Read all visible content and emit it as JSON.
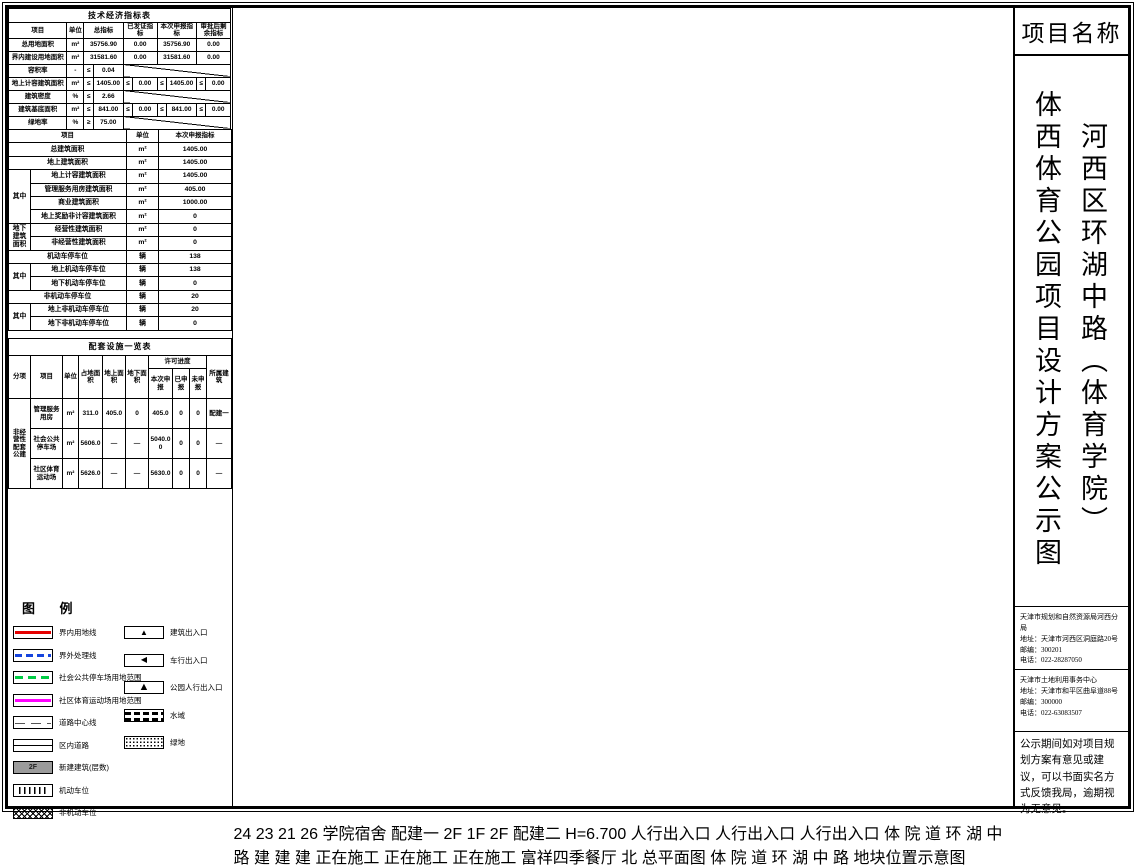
{
  "tables": {
    "tech": {
      "rows": [
        [
          {
            "t": "技术经济指标表",
            "cs": 10,
            "c": "cap"
          }
        ],
        [
          {
            "t": "项目",
            "c": "h"
          },
          {
            "t": "单位",
            "c": "h"
          },
          {
            "t": "总指标",
            "cs": 2,
            "c": "h"
          },
          {
            "t": "已发证指标",
            "cs": 2,
            "c": "h"
          },
          {
            "t": "本次申报指标",
            "cs": 2,
            "c": "h"
          },
          {
            "t": "审批后剩余指标",
            "cs": 2,
            "c": "h"
          }
        ],
        [
          {
            "t": "总用地面积"
          },
          {
            "t": "m²"
          },
          {
            "t": "35756.90",
            "cs": 2
          },
          {
            "t": "0.00",
            "cs": 2
          },
          {
            "t": "35756.90",
            "cs": 2
          },
          {
            "t": "0.00",
            "cs": 2
          }
        ],
        [
          {
            "t": "界内建设用地面积"
          },
          {
            "t": "m²"
          },
          {
            "t": "31581.60",
            "cs": 2
          },
          {
            "t": "0.00",
            "cs": 2
          },
          {
            "t": "31581.60",
            "cs": 2
          },
          {
            "t": "0.00",
            "cs": 2
          }
        ],
        [
          {
            "t": "容积率"
          },
          {
            "t": "-"
          },
          {
            "t": "≤"
          },
          {
            "t": "0.04"
          },
          {
            "t": "",
            "cs": 6,
            "c": "diag"
          }
        ],
        [
          {
            "t": "地上计容建筑面积"
          },
          {
            "t": "m²"
          },
          {
            "t": "≤"
          },
          {
            "t": "1405.00"
          },
          {
            "t": "≤"
          },
          {
            "t": "0.00"
          },
          {
            "t": "≤"
          },
          {
            "t": "1405.00"
          },
          {
            "t": "≤"
          },
          {
            "t": "0.00"
          }
        ],
        [
          {
            "t": "建筑密度"
          },
          {
            "t": "%"
          },
          {
            "t": "≤"
          },
          {
            "t": "2.66"
          },
          {
            "t": "",
            "cs": 6,
            "c": "diag"
          }
        ],
        [
          {
            "t": "建筑基底面积"
          },
          {
            "t": "m²"
          },
          {
            "t": "≤"
          },
          {
            "t": "841.00"
          },
          {
            "t": "≤"
          },
          {
            "t": "0.00"
          },
          {
            "t": "≤"
          },
          {
            "t": "841.00"
          },
          {
            "t": "≤"
          },
          {
            "t": "0.00"
          }
        ],
        [
          {
            "t": "绿地率"
          },
          {
            "t": "%"
          },
          {
            "t": "≥"
          },
          {
            "t": "75.00"
          },
          {
            "t": "",
            "cs": 6,
            "c": "diag"
          }
        ],
        [
          {
            "t": "绿地面积(含水域)"
          },
          {
            "t": "m²"
          },
          {
            "t": "≥"
          },
          {
            "t": "23948.70"
          },
          {
            "t": "≥"
          },
          {
            "t": "0.00"
          },
          {
            "t": "≥"
          },
          {
            "t": "23948.70"
          },
          {
            "t": "≥"
          },
          {
            "t": "0.00"
          }
        ]
      ]
    },
    "declare": {
      "rows": [
        [
          {
            "t": "项目",
            "cs": 2,
            "c": "h"
          },
          {
            "t": "单位",
            "c": "h"
          },
          {
            "t": "本次申报指标",
            "c": "h"
          }
        ],
        [
          {
            "t": "总建筑面积",
            "cs": 2
          },
          {
            "t": "m²"
          },
          {
            "t": "1405.00"
          }
        ],
        [
          {
            "t": "地上建筑面积",
            "cs": 2
          },
          {
            "t": "m²"
          },
          {
            "t": "1405.00"
          }
        ],
        [
          {
            "t": "其中",
            "rs": 4
          },
          {
            "t": "地上计容建筑面积"
          },
          {
            "t": "m²"
          },
          {
            "t": "1405.00"
          }
        ],
        [
          {
            "t": "管理服务用房建筑面积"
          },
          {
            "t": "m²"
          },
          {
            "t": "405.00"
          }
        ],
        [
          {
            "t": "商业建筑面积"
          },
          {
            "t": "m²"
          },
          {
            "t": "1000.00"
          }
        ],
        [
          {
            "t": "地上奖励非计容建筑面积"
          },
          {
            "t": "m²"
          },
          {
            "t": "0"
          }
        ],
        [
          {
            "t": "地下建筑面积",
            "rs": 2
          },
          {
            "t": "经营性建筑面积"
          },
          {
            "t": "m²"
          },
          {
            "t": "0"
          }
        ],
        [
          {
            "t": "非经营性建筑面积"
          },
          {
            "t": "m²"
          },
          {
            "t": "0"
          }
        ],
        [
          {
            "t": "机动车停车位",
            "cs": 2
          },
          {
            "t": "辆"
          },
          {
            "t": "138"
          }
        ],
        [
          {
            "t": "其中",
            "rs": 2
          },
          {
            "t": "地上机动车停车位"
          },
          {
            "t": "辆"
          },
          {
            "t": "138"
          }
        ],
        [
          {
            "t": "地下机动车停车位"
          },
          {
            "t": "辆"
          },
          {
            "t": "0"
          }
        ],
        [
          {
            "t": "非机动车停车位",
            "cs": 2
          },
          {
            "t": "辆"
          },
          {
            "t": "20"
          }
        ],
        [
          {
            "t": "其中",
            "rs": 2
          },
          {
            "t": "地上非机动车停车位"
          },
          {
            "t": "辆"
          },
          {
            "t": "20"
          }
        ],
        [
          {
            "t": "地下非机动车停车位"
          },
          {
            "t": "辆"
          },
          {
            "t": "0"
          }
        ]
      ]
    },
    "facility": {
      "rows": [
        [
          {
            "t": "配套设施一览表",
            "cs": 10,
            "c": "cap"
          }
        ],
        [
          {
            "t": "分项",
            "rs": 2,
            "c": "h"
          },
          {
            "t": "项目",
            "rs": 2,
            "c": "h"
          },
          {
            "t": "单位",
            "rs": 2,
            "c": "h"
          },
          {
            "t": "占地面积",
            "rs": 2,
            "c": "h"
          },
          {
            "t": "地上面积",
            "rs": 2,
            "c": "h"
          },
          {
            "t": "地下面积",
            "rs": 2,
            "c": "h"
          },
          {
            "t": "许可进度",
            "cs": 3,
            "c": "h"
          },
          {
            "t": "所属建筑",
            "rs": 2,
            "c": "h"
          }
        ],
        [
          {
            "t": "本次申报",
            "c": "h"
          },
          {
            "t": "已申报",
            "c": "h"
          },
          {
            "t": "未申报",
            "c": "h"
          }
        ],
        [
          {
            "t": "非经营性配套公建",
            "rs": 3
          },
          {
            "t": "管理服务用房"
          },
          {
            "t": "m²"
          },
          {
            "t": "311.0"
          },
          {
            "t": "405.0"
          },
          {
            "t": "0"
          },
          {
            "t": "405.0"
          },
          {
            "t": "0"
          },
          {
            "t": "0"
          },
          {
            "t": "配建一"
          }
        ],
        [
          {
            "t": "社会公共停车场"
          },
          {
            "t": "m²"
          },
          {
            "t": "5606.0"
          },
          {
            "t": "—"
          },
          {
            "t": "—"
          },
          {
            "t": "5040.00"
          },
          {
            "t": "0"
          },
          {
            "t": "0"
          },
          {
            "t": "—"
          }
        ],
        [
          {
            "t": "社区体育运动场"
          },
          {
            "t": "m²"
          },
          {
            "t": "5626.0"
          },
          {
            "t": "—"
          },
          {
            "t": "—"
          },
          {
            "t": "5630.0"
          },
          {
            "t": "0"
          },
          {
            "t": "0"
          },
          {
            "t": "—"
          }
        ]
      ]
    }
  },
  "legend": {
    "title": "图    例",
    "left": [
      {
        "type": "red",
        "label": "界内用地线"
      },
      {
        "type": "blue",
        "label": "界外处理线"
      },
      {
        "type": "green",
        "label": "社会公共停车场用地范围"
      },
      {
        "type": "magenta",
        "label": "社区体育运动场用地范围"
      },
      {
        "type": "center",
        "label": "道路中心线"
      },
      {
        "type": "innerroad",
        "label": "区内道路"
      },
      {
        "type": "newbld",
        "label": "新建建筑(层数)",
        "glyph": "2F"
      },
      {
        "type": "parking",
        "label": "机动车位"
      },
      {
        "type": "nonmotor",
        "label": "非机动车位"
      }
    ],
    "right": [
      {
        "type": "bent",
        "label": "建筑出入口",
        "glyph": "▲"
      },
      {
        "type": "vent",
        "label": "车行出入口",
        "glyph": "◀"
      },
      {
        "type": "pent",
        "label": "公园人行出入口",
        "glyph": "▲"
      },
      {
        "type": "water",
        "label": "水域"
      },
      {
        "type": "greenarea",
        "label": "绿地"
      }
    ]
  },
  "plan": {
    "road1": [
      "体",
      "院",
      "道"
    ],
    "road2": [
      "环",
      "湖",
      "中",
      "路"
    ],
    "caption": "总平面图",
    "north": "北",
    "building1": "配建一",
    "building2": "配建二",
    "floor": "2F",
    "floor1": "1F",
    "height_note": "H=6.700",
    "construction": "正在施工",
    "restaurant": "富祥四季餐厅",
    "ped_entrance": "人行出入口",
    "bld": "建",
    "dorm": "学院宿舍",
    "nums": [
      "24",
      "23",
      "21",
      "26"
    ],
    "locmap": {
      "caption": "地块位置示意图"
    }
  },
  "title_block": {
    "header": "项目名称",
    "title_right": "河西区环湖中路（体育学院）",
    "title_left": "体西体育公园项目设计方案公示图",
    "agency1": {
      "name": "天津市规划和自然资源局河西分局",
      "address": "地址：天津市河西区洞庭路20号",
      "postcode": "邮编：300201",
      "phone": "电话：022-28287050"
    },
    "agency2": {
      "name": "天津市土地利用事务中心",
      "address": "地址：天津市和平区曲阜道88号",
      "postcode": "邮编：300000",
      "phone": "电话：022-63083507"
    },
    "notice": "公示期间如对项目规划方案有意见或建议，可以书面实名方式反馈我局，逾期视为无意见。"
  }
}
